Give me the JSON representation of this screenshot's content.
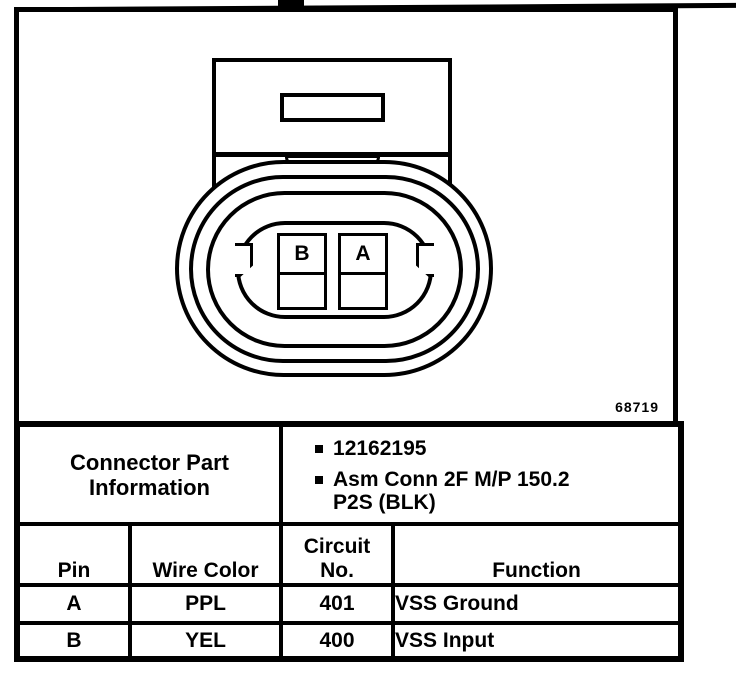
{
  "colors": {
    "ink": "#000000",
    "paper": "#ffffff"
  },
  "figure": {
    "figure_number": "68719",
    "connector": {
      "pin_labels": [
        "B",
        "A"
      ]
    },
    "part_info": {
      "label": "Connector Part\nInformation",
      "bullets": [
        "12162195",
        "Asm Conn 2F M/P 150.2\nP2S (BLK)"
      ]
    },
    "pin_table": {
      "headers": [
        "Pin",
        "Wire Color",
        "Circuit\nNo.",
        "Function"
      ],
      "rows": [
        {
          "pin": "A",
          "wire_color": "PPL",
          "circuit_no": "401",
          "function": "VSS Ground"
        },
        {
          "pin": "B",
          "wire_color": "YEL",
          "circuit_no": "400",
          "function": "VSS Input"
        }
      ]
    }
  }
}
